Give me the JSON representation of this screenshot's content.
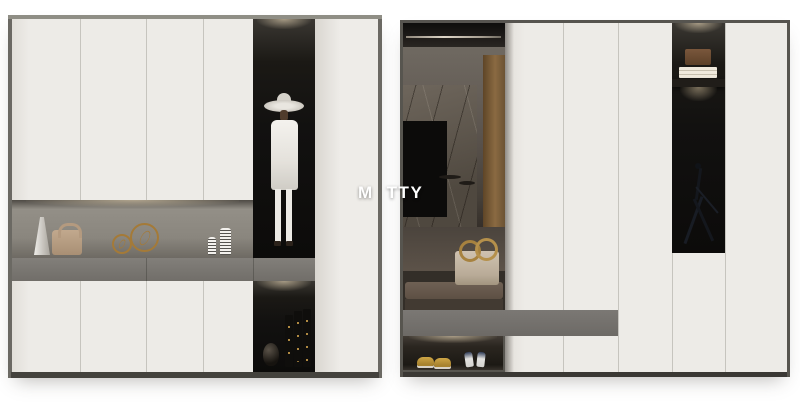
{
  "watermark": {
    "part1": "M",
    "part2": "TTY"
  },
  "scene": {
    "description": "Two side-by-side 3D renders of a modern white entryway wardrobe cabinet system with dark display alcoves",
    "left_panel": {
      "name": "closed white wardrobe with lit display niche, mannequin alcove and book alcove",
      "decor_items": [
        "white angular vase",
        "tan leather handbag",
        "two gold wire spheres",
        "two white striped vases",
        "mannequin with white wide-brim hat and long white coat",
        "dark round vase",
        "three black books with gold spine text"
      ]
    },
    "right_panel": {
      "name": "same wardrobe with open sliding section revealing the room interior",
      "decor_items": [
        "metal clothes rail",
        "marble tv wall with tv screen",
        "round coffee tables",
        "brown bench cushion",
        "beige handbag with gold ring handles",
        "brown box",
        "stack of white books",
        "black abstract wire figurine",
        "yellow loafers",
        "white and navy heels"
      ]
    },
    "colors": {
      "background": "#ffffff",
      "door_white": "#edebe7",
      "frame_gray": "#6b6963",
      "top_strip": "#8f8e85",
      "drawer_band_gray": "#7a7772",
      "niche_taupe": "#8a867e",
      "alcove_black": "#121110",
      "accent_gold": "#a7823f",
      "bench_brown": "#63564b",
      "bag_beige": "#c4b7a5",
      "shoe_yellow": "#c49d3f",
      "wood_brown": "#8a6a42"
    }
  }
}
